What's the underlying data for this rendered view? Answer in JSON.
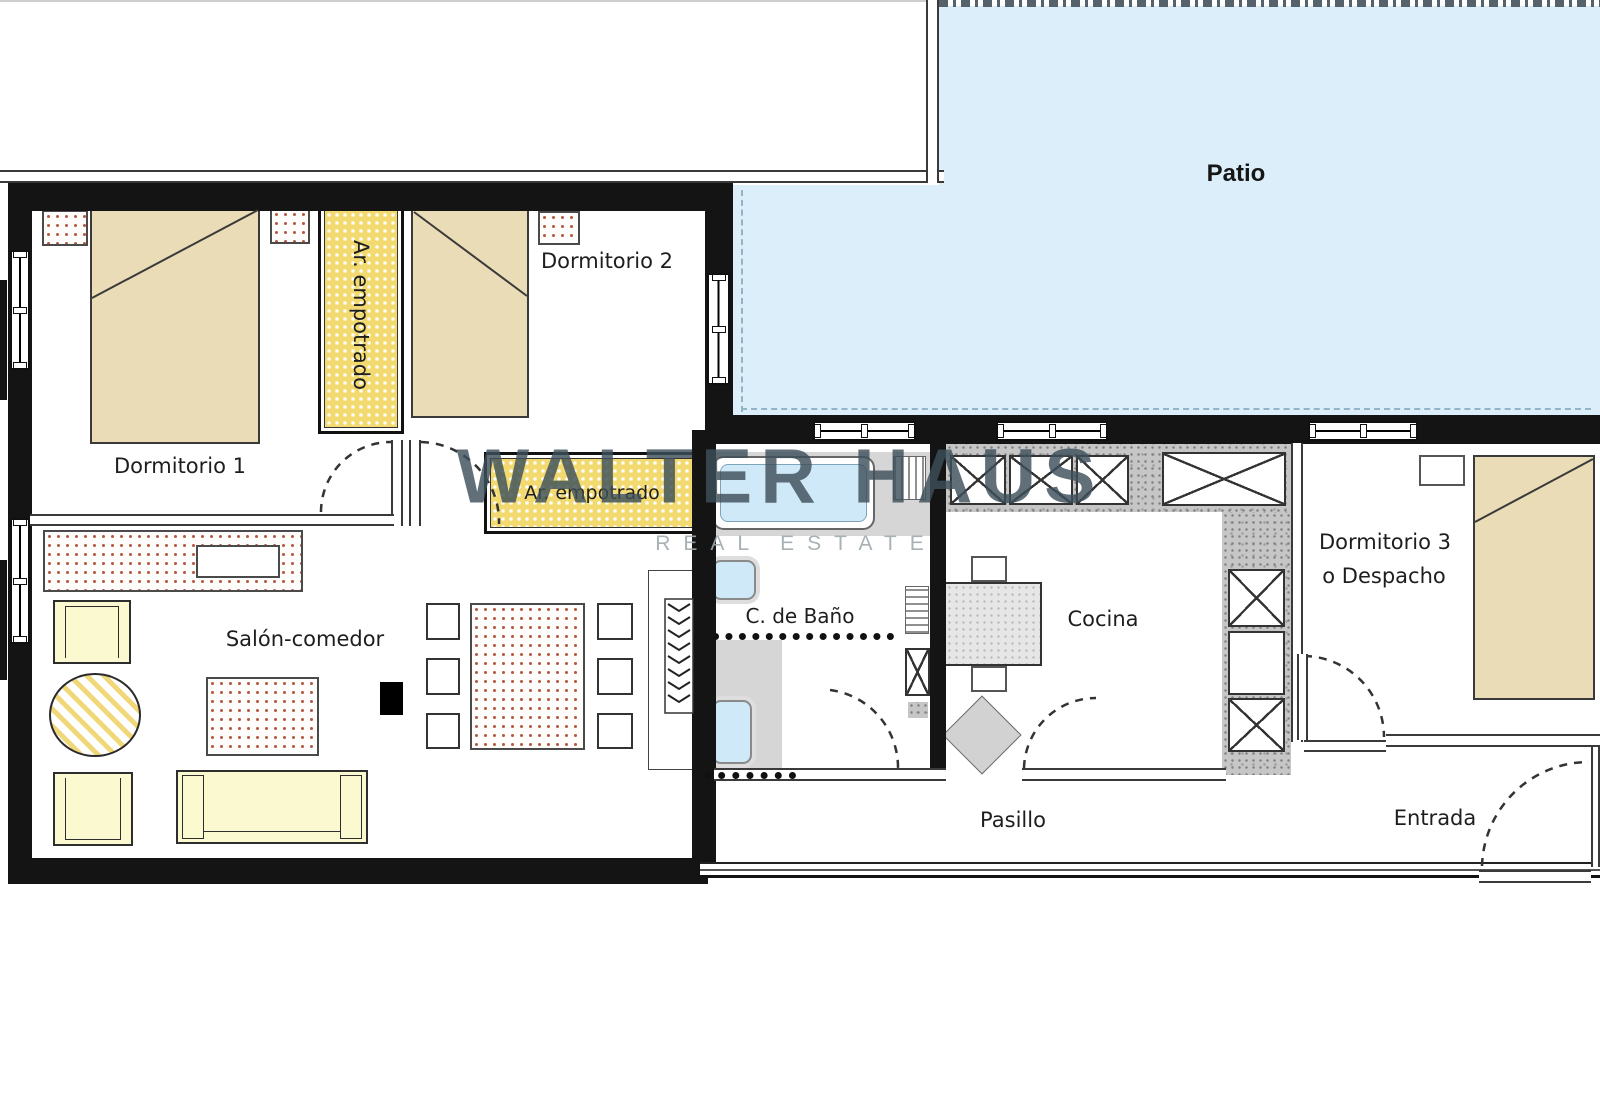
{
  "watermark": {
    "title": "WALTER HAUS",
    "subtitle": "REAL ESTATE"
  },
  "rooms": {
    "patio": {
      "label": "Patio"
    },
    "dormitorio1": {
      "label": "Dormitorio 1"
    },
    "dormitorio2": {
      "label": "Dormitorio 2"
    },
    "dormitorio3": {
      "label": "Dormitorio 3",
      "label2": "o Despacho"
    },
    "salon": {
      "label": "Salón-comedor"
    },
    "bano": {
      "label": "C. de Baño"
    },
    "cocina": {
      "label": "Cocina"
    },
    "pasillo": {
      "label": "Pasillo"
    },
    "entrada": {
      "label": "Entrada"
    }
  },
  "closets": {
    "vertical_label": "Ar. empotrado",
    "horizontal_label": "Ar. empotrado"
  },
  "colors": {
    "patio_fill": "#dceef9",
    "closet_fill": "#f3da70",
    "bed_fill": "#eadcb6",
    "sofa_fill": "#fbf9cf",
    "fixture_fill": "#cfe9f8",
    "dot_accent": "#b65c45",
    "wall": "#141414",
    "watermark": "#3d4f59"
  }
}
